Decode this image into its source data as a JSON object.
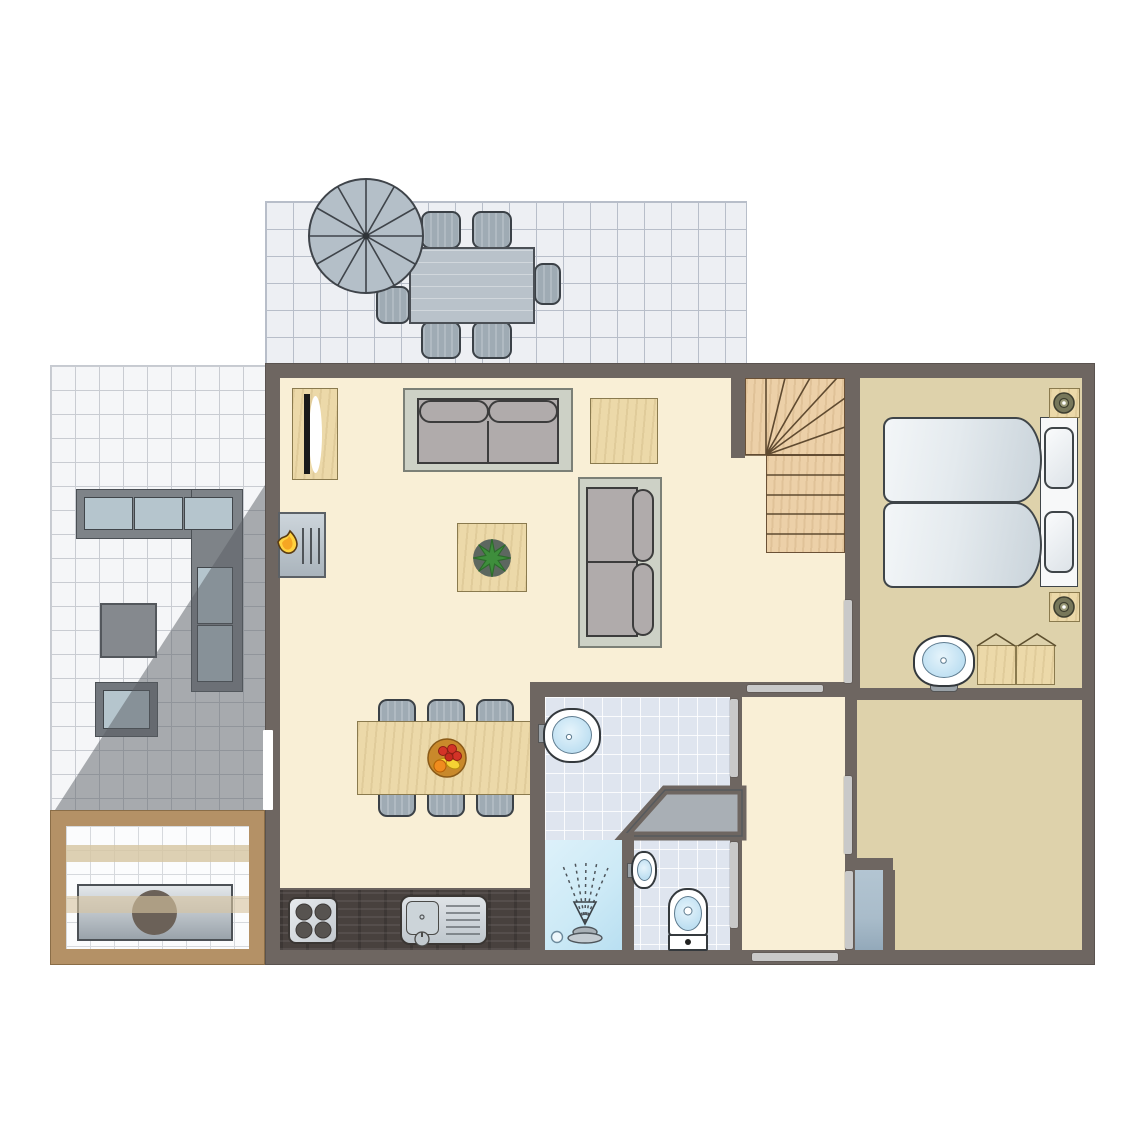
{
  "title": "holiday-home-ground-floor-plan",
  "colors": {
    "wall": "#6e6661",
    "living_floor": "#f9efd6",
    "bedroom_floor": "#ded2ab",
    "bath_tile": "#dfe5ef",
    "patio_tile_top": "#edeff3",
    "patio_tile_left": "#f5f6f8",
    "patio_line": "#b8bec9",
    "pergola_wood": "#b49166",
    "counter": "#48413e",
    "wood": "#ecd9a9",
    "sofa_gray": "#b0abab",
    "sofa_frame": "#cdd1c6",
    "outdoor_gray": "#9fabb4",
    "metal": "#b9c2ca",
    "door_bar": "#c9c9c9",
    "shower_blue": "#cdeaf6",
    "fixture_blue": "#bfe0f2",
    "closet_blue": "#a9bcca",
    "shadow": "rgba(90,94,100,0.5)",
    "flame_yellow": "#ffd23f",
    "flame_orange": "#f6a623",
    "plant_green": "#3e8e3c",
    "stair_wood": "#ecd0a8"
  },
  "rooms": [
    {
      "id": "patio-top",
      "kind": "outdoor-terrace",
      "furniture": [
        "parasol",
        "outdoor-dining-table",
        "outdoor-chair x6"
      ]
    },
    {
      "id": "patio-left",
      "kind": "outdoor-terrace",
      "furniture": [
        "outdoor-corner-sofa",
        "outdoor-side-table",
        "outdoor-ottoman",
        "shade-shadow"
      ]
    },
    {
      "id": "veranda",
      "kind": "covered-terrace",
      "furniture": [
        "barbecue-table",
        "roof-beam x2"
      ]
    },
    {
      "id": "living-room",
      "kind": "living-kitchen",
      "furniture": [
        "tv-cabinet",
        "fireplace",
        "sofa-2seat x2",
        "side-table",
        "coffee-table-with-plant",
        "dining-table",
        "dining-chair x6",
        "fruit-bowl",
        "kitchen-counter",
        "stove",
        "kitchen-sink"
      ]
    },
    {
      "id": "stairs",
      "kind": "staircase",
      "furniture": [
        "winder-steps",
        "straight-steps x5"
      ]
    },
    {
      "id": "bedroom-1",
      "kind": "bedroom",
      "furniture": [
        "single-bed x2",
        "pillow x2",
        "nightstand-with-lamp x2",
        "wash-basin",
        "wardrobe"
      ]
    },
    {
      "id": "bedroom-2",
      "kind": "bedroom",
      "furniture": []
    },
    {
      "id": "bathroom",
      "kind": "bathroom",
      "furniture": [
        "wash-basin",
        "shower",
        "under-stairs-storage"
      ]
    },
    {
      "id": "toilet",
      "kind": "wc",
      "furniture": [
        "small-basin",
        "toilet"
      ]
    },
    {
      "id": "hallway",
      "kind": "hall",
      "furniture": []
    },
    {
      "id": "storage-closet",
      "kind": "closet",
      "furniture": []
    }
  ],
  "openings": [
    {
      "id": "door-living-hallway"
    },
    {
      "id": "door-hallway-bathroom"
    },
    {
      "id": "door-hallway-toilet"
    },
    {
      "id": "door-hallway-bedroom-2"
    },
    {
      "id": "door-closet"
    },
    {
      "id": "door-exterior-hallway"
    },
    {
      "id": "door-living-bedroom-1"
    },
    {
      "id": "patio-sliding-door"
    }
  ]
}
